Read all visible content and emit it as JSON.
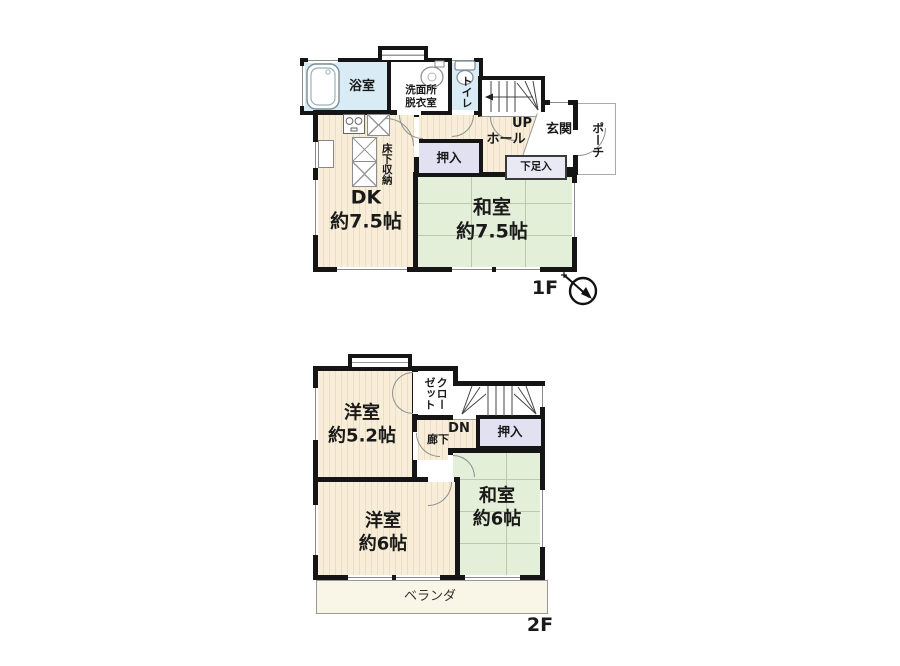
{
  "floor1": {
    "floor_label": "1F",
    "bath": "浴室",
    "washroom": "洗面所\n脱衣室",
    "toilet": "トイレ",
    "stairs_up": "UP",
    "hall": "ホール",
    "genkan": "玄関",
    "porch": "ポーチ",
    "oshiire": "押入",
    "shoe_box": "下足入",
    "dk": "DK\n約7.5帖",
    "underfloor_storage": "床下収納",
    "washitsu": "和室\n約7.5帖"
  },
  "floor2": {
    "floor_label": "2F",
    "western_room_small": "洋室\n約5.2帖",
    "closet": "クローゼット",
    "stairs_down": "DN",
    "corridor": "廊下",
    "oshiire": "押入",
    "washitsu": "和室\n約6帖",
    "western_room_large": "洋室\n約6帖",
    "veranda": "ベランダ"
  },
  "icons": [
    "bathtub-icon",
    "sink-icon",
    "toilet-icon",
    "stove-icon",
    "refrigerator-icon",
    "kitchen-counter-icon",
    "washer-pan-icon",
    "stairs-up-icon",
    "stairs-down-icon",
    "north-arrow-compass-icon"
  ],
  "colors": {
    "wall": "#151515",
    "wood_floor": "#f7edd8",
    "wood_floor_stripe": "#eadfc2",
    "tatami": "#e4efd9",
    "tatami_line": "#bcc9aa",
    "water_area": "#d9ecf5",
    "storage": "#e1e1f2",
    "veranda_floor": "#faf6e7",
    "text": "#1a1a1a",
    "background": "#ffffff"
  }
}
